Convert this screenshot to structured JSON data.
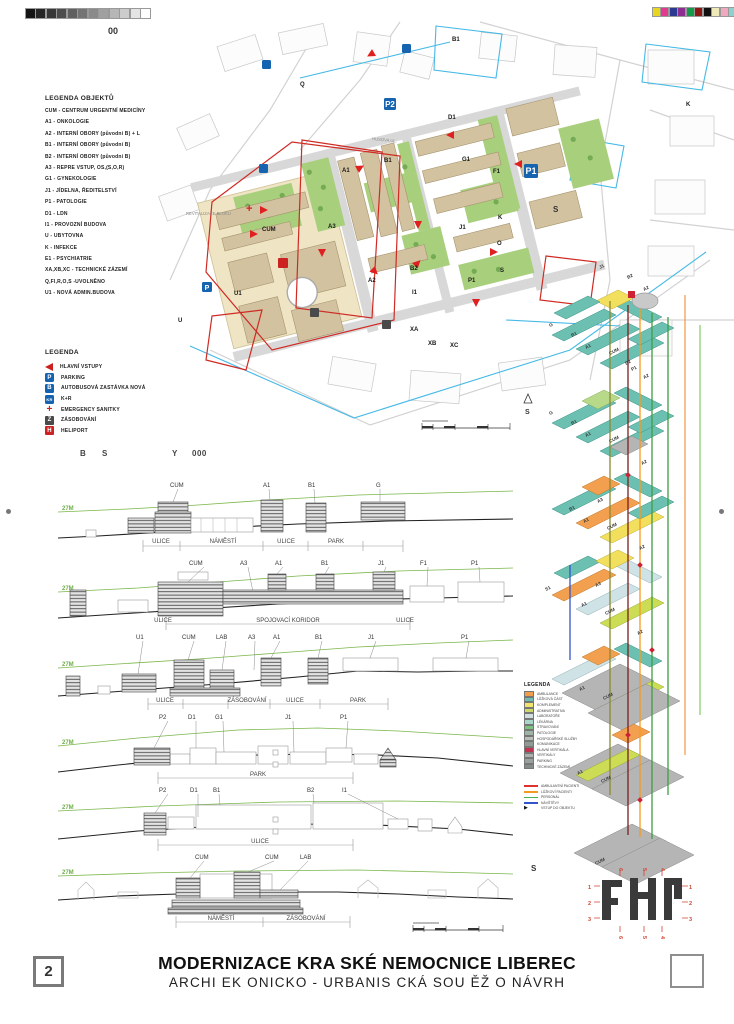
{
  "page": {
    "sheet_code": "00",
    "sheet_number": "2",
    "title": "MODERNIZACE KRA SKÉ NEMOCNICE LIBEREC",
    "subtitle": "ARCHI EK ONICKO - URBANIS CKÁ SOU ĚŽ O NÁVRH"
  },
  "calibration": {
    "grayscale": [
      "#141414",
      "#262626",
      "#383838",
      "#4c4c4c",
      "#606060",
      "#747474",
      "#8a8a8a",
      "#a0a0a0",
      "#b6b6b6",
      "#cccccc",
      "#e4e4e4",
      "#ffffff"
    ],
    "colors": [
      "#e8d51f",
      "#e23a8e",
      "#2b3990",
      "#8c2f90",
      "#149a49",
      "#8c1713",
      "#111111",
      "#efe8b8",
      "#f0a8c0",
      "#8fd0cc",
      "#98a0a4"
    ]
  },
  "legend_objects": {
    "title": "LEGENDA OBJEKTŮ",
    "items": [
      "CUM -  CENTRUM URGENTNÍ MEDICÍNY",
      "A1 - ONKOLOGIE",
      "A2 - INTERNÍ OBORY (původní B) + L",
      "B1 - INTERNÍ OBORY (původní B)",
      "B2 - INTERNÍ OBORY (původní B)",
      "A3 - REPRE VSTUP, OS,(S,O,R)",
      "G1 - GYNEKOLOGIE",
      "J1 - JÍDELNA, ŘEDITELSTVÍ",
      "P1 - PATOLOGIE",
      "D1 - LDN",
      "I1 - PROVOZNÍ BUDOVA",
      "U - UBYTOVNA",
      "K - INFEKCE",
      "E1 - PSYCHIATRIE",
      "XA,XB,XC - TECHNICKÉ ZÁZEMÍ",
      "Q,FI,R,O,S -UVOLNĚNO",
      "U1 - NOVÁ ADMIN.BUDOVA"
    ]
  },
  "legend_symbols": {
    "title": "LEGENDA",
    "items": [
      {
        "icon": "entrance-arrow",
        "label": "HLAVNÍ VSTUPY"
      },
      {
        "icon": "parking",
        "glyph": "P",
        "label": "PARKING"
      },
      {
        "icon": "bus-stop",
        "glyph": "B",
        "label": "AUTOBUSOVÁ ZASTÁVKA NOVÁ"
      },
      {
        "icon": "kiss-and-ride",
        "glyph": "KR",
        "label": "K+R"
      },
      {
        "icon": "emergency-cross",
        "glyph": "+",
        "label": "EMERGENCY SANITKY"
      },
      {
        "icon": "supply",
        "glyph": "Z",
        "label": "ZÁSOBOVÁNÍ"
      },
      {
        "icon": "heliport",
        "glyph": "H",
        "label": "HELIPORT"
      }
    ]
  },
  "sections_heading": {
    "parts": [
      "B",
      "S",
      "Y",
      "000"
    ]
  },
  "sections": [
    {
      "height_label": "27M",
      "buildings": [
        "CUM",
        "A1",
        "B1",
        "G"
      ],
      "streets": [
        "ULICE",
        "NÁMĚSTÍ",
        "ULICE",
        "PARK"
      ]
    },
    {
      "height_label": "27M",
      "buildings": [
        "CUM",
        "A3",
        "A1",
        "B1",
        "J1",
        "F1",
        "P1"
      ],
      "streets": [
        "ULICE",
        "SPOJOVACÍ KORIDOR",
        "ULICE"
      ]
    },
    {
      "height_label": "27M",
      "buildings": [
        "U1",
        "CUM",
        "LAB",
        "A3",
        "A1",
        "B1",
        "J1",
        "P1"
      ],
      "streets": [
        "ULICE",
        "ZÁSOBOVÁNÍ",
        "ULICE",
        "PARK"
      ]
    },
    {
      "height_label": "27M",
      "buildings": [
        "P2",
        "D1",
        "G1",
        "J1",
        "P1"
      ],
      "streets": [
        "PARK"
      ]
    },
    {
      "height_label": "27M",
      "buildings": [
        "P2",
        "D1",
        "B1",
        "B2",
        "I1"
      ],
      "streets": [
        "ULICE"
      ]
    },
    {
      "height_label": "27M",
      "buildings": [
        "CUM",
        "CUM",
        "LAB"
      ],
      "streets": [
        "NÁMĚSTÍ",
        "ZÁSOBOVÁNÍ"
      ]
    }
  ],
  "map": {
    "labels": [
      "B1",
      "Q",
      "D1",
      "A1",
      "B1",
      "G1",
      "F1",
      "K",
      "A3",
      "CUM",
      "J1",
      "O",
      "S",
      "A2",
      "B2",
      "P1",
      "I1",
      "U1",
      "U",
      "XA",
      "XB",
      "XC",
      "K"
    ],
    "parking_labels": [
      "P2",
      "P1",
      "P"
    ],
    "block_note": "REVITALIZACE BLOKU",
    "street_name": "HUSOVA UL.",
    "north_label": "S"
  },
  "axon": {
    "view_label_top": "S",
    "view_label_bottom": "S",
    "plate_labels": [
      "J1",
      "B2",
      "A2",
      "G",
      "B1",
      "A1",
      "CUM",
      "P1",
      "B2",
      "A2",
      "G",
      "B1",
      "A1",
      "CUM",
      "A2",
      "A3",
      "B1",
      "A1",
      "CUM",
      "A2",
      "A3",
      "A1",
      "CUM",
      "S1",
      "A2",
      "A1",
      "CUM",
      "A1",
      "CUM",
      "CUM"
    ],
    "legend": {
      "title": "LEGENDA",
      "items": [
        {
          "color": "#f09e4a",
          "label": "AMBULANCE"
        },
        {
          "color": "#6fbfae",
          "label": "LŮŽKOVÁ ČÁST"
        },
        {
          "color": "#f2e56e",
          "label": "KOMPLEMENT"
        },
        {
          "color": "#cdd96a",
          "label": "ADMINISTRATIVA"
        },
        {
          "color": "#cfdede",
          "label": "LABORATOŘE"
        },
        {
          "color": "#a8d6c8",
          "label": "LÉKÁRNA"
        },
        {
          "color": "#7cc47e",
          "label": "STRAVOVÁNÍ"
        },
        {
          "color": "#9fb4a6",
          "label": "PATOLOGIE"
        },
        {
          "color": "#b8bfb8",
          "label": "HOSPODÁŘSKÉ SLUŽBY"
        },
        {
          "color": "#8f9a94",
          "label": "KOMUNIKACE"
        },
        {
          "color": "#c23352",
          "label": "HLAVNÍ VERTIKÁLA"
        },
        {
          "color": "#aab0ac",
          "label": "VERTIKÁLY"
        },
        {
          "color": "#9aa0a0",
          "label": "PARKING"
        },
        {
          "color": "#848c8a",
          "label": "TECHNICKÉ ZÁZEMÍ"
        }
      ],
      "flows": [
        {
          "color": "#e03030",
          "label": "AMBULANTNÍ PACIENTI"
        },
        {
          "color": "#f49c20",
          "label": "LŮŽKOVÍ PACIENTI"
        },
        {
          "color": "#4caf50",
          "label": "PERSONÁL"
        },
        {
          "color": "#3355cc",
          "label": "NÁVŠTĚVY"
        }
      ],
      "entry": {
        "label": "VSTUP DO OBJEKTU"
      }
    }
  },
  "key_plan": {
    "left": [
      "1",
      "2",
      "3"
    ],
    "right": [
      "1",
      "2",
      "3"
    ],
    "top": [
      "6",
      "5",
      "4"
    ],
    "bottom": [
      "6",
      "5",
      "4"
    ]
  }
}
